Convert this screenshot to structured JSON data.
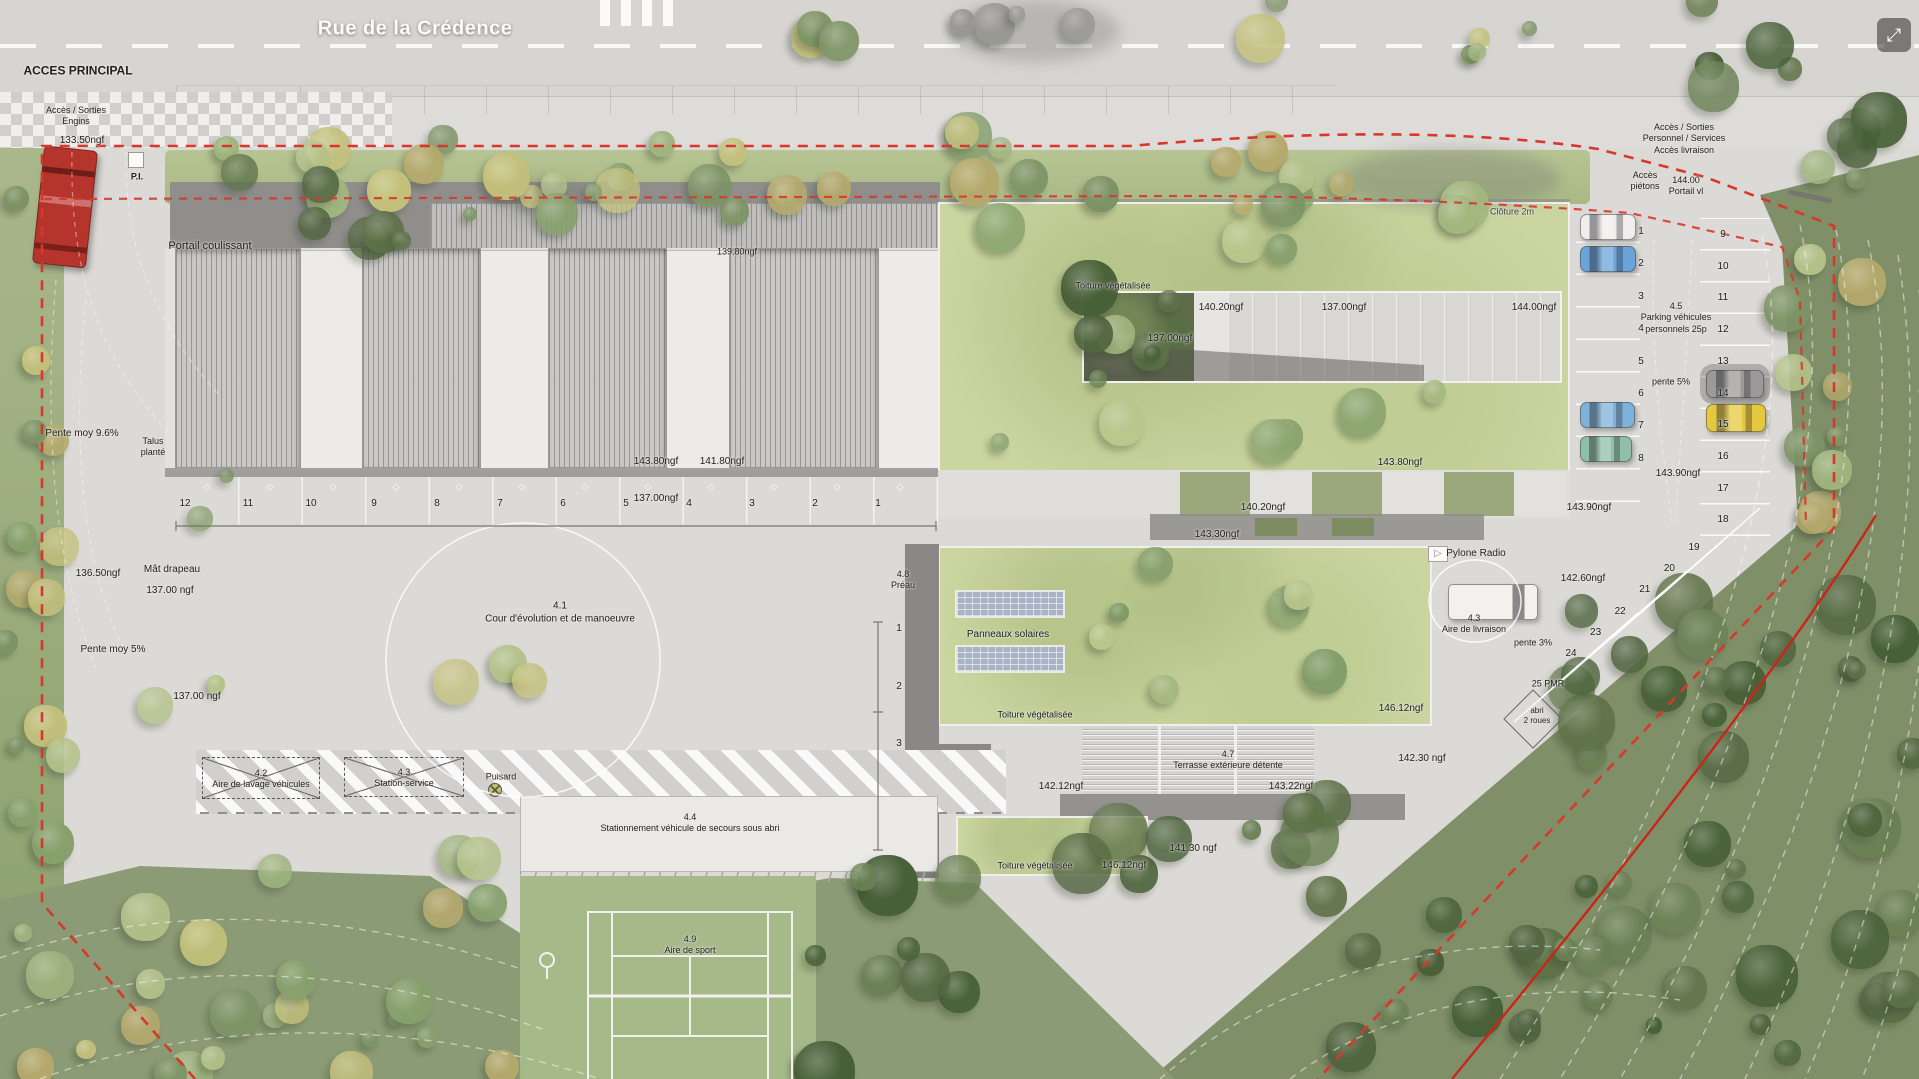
{
  "viewer": {
    "fullscreen_icon": "⤢"
  },
  "colors": {
    "boundary_red": "#d8372b",
    "solid_red": "#cc2418",
    "roof_green": "#cbd5a0",
    "forest_green": "#7f9068",
    "road_gray": "#d7d5d2",
    "truck_red": "#b5352c",
    "car_yellow": "#e6c83e",
    "car_blue": "#6aa4d8"
  },
  "annotations": [
    {
      "text": "Rue de la Crédence",
      "x": 415,
      "y": 29,
      "size": 20,
      "cls": "street"
    },
    {
      "text": "ACCES PRINCIPAL",
      "x": 78,
      "y": 71,
      "size": 12,
      "weight": "600"
    },
    {
      "text": "Accès / Sorties\nEngins",
      "x": 76,
      "y": 116,
      "size": 9
    },
    {
      "text": "133.50ngf",
      "x": 82,
      "y": 141,
      "size": 10
    },
    {
      "text": "P.I.",
      "x": 137,
      "y": 177,
      "size": 9,
      "weight": "600"
    },
    {
      "text": "Portail coulissant",
      "x": 210,
      "y": 247,
      "size": 11
    },
    {
      "text": "Pente moy 9.6%",
      "x": 82,
      "y": 434,
      "size": 10
    },
    {
      "text": "Talus\nplanté",
      "x": 153,
      "y": 447,
      "size": 9
    },
    {
      "text": "136.50ngf",
      "x": 98,
      "y": 574,
      "size": 10
    },
    {
      "text": "Mât drapeau",
      "x": 172,
      "y": 570,
      "size": 10
    },
    {
      "text": "137.00 ngf",
      "x": 170,
      "y": 591,
      "size": 10
    },
    {
      "text": "Pente moy 5%",
      "x": 113,
      "y": 650,
      "size": 10
    },
    {
      "text": "137.00 ngf",
      "x": 197,
      "y": 697,
      "size": 10
    },
    {
      "text": "4.1\nCour d'évolution et de manoeuvre",
      "x": 560,
      "y": 613,
      "size": 10
    },
    {
      "text": "139.80ngf",
      "x": 737,
      "y": 252,
      "size": 9
    },
    {
      "text": "143.80ngf",
      "x": 656,
      "y": 462,
      "size": 10
    },
    {
      "text": "141.80ngf",
      "x": 722,
      "y": 462,
      "size": 10
    },
    {
      "text": "137.00ngf",
      "x": 656,
      "y": 499,
      "size": 10
    },
    {
      "text": "Toiture végétalisée",
      "x": 1113,
      "y": 286,
      "size": 9
    },
    {
      "text": "140.20ngf",
      "x": 1221,
      "y": 308,
      "size": 10
    },
    {
      "text": "137.00ngf",
      "x": 1344,
      "y": 308,
      "size": 10
    },
    {
      "text": "144.00ngf",
      "x": 1534,
      "y": 308,
      "size": 10
    },
    {
      "text": "137.00ngf",
      "x": 1170,
      "y": 339,
      "size": 10
    },
    {
      "text": "143.80ngf",
      "x": 1400,
      "y": 463,
      "size": 10
    },
    {
      "text": "140.20ngf",
      "x": 1263,
      "y": 508,
      "size": 10
    },
    {
      "text": "143.30ngf",
      "x": 1217,
      "y": 535,
      "size": 10
    },
    {
      "text": "143.90ngf",
      "x": 1589,
      "y": 508,
      "size": 10
    },
    {
      "text": "4.8\nPréau",
      "x": 903,
      "y": 580,
      "size": 9
    },
    {
      "text": "Panneaux solaires",
      "x": 1008,
      "y": 635,
      "size": 10
    },
    {
      "text": "Toiture végétalisée",
      "x": 1035,
      "y": 715,
      "size": 9
    },
    {
      "text": "146.12ngf",
      "x": 1401,
      "y": 709,
      "size": 10
    },
    {
      "text": "4.7\nTerrasse extérieure détente",
      "x": 1228,
      "y": 760,
      "size": 9
    },
    {
      "text": "142.12ngf",
      "x": 1061,
      "y": 787,
      "size": 10
    },
    {
      "text": "143.22ngf",
      "x": 1291,
      "y": 787,
      "size": 10
    },
    {
      "text": "142.30 ngf",
      "x": 1422,
      "y": 759,
      "size": 10
    },
    {
      "text": "Toiture végétalisée",
      "x": 1035,
      "y": 866,
      "size": 9
    },
    {
      "text": "146.12ngf",
      "x": 1124,
      "y": 866,
      "size": 10
    },
    {
      "text": "141.30 ngf",
      "x": 1193,
      "y": 849,
      "size": 10
    },
    {
      "text": "4.2\nAire de lavage véhicules",
      "x": 261,
      "y": 779,
      "size": 9
    },
    {
      "text": "4.3\nStation-service",
      "x": 404,
      "y": 778,
      "size": 9
    },
    {
      "text": "Puisard",
      "x": 501,
      "y": 777,
      "size": 9
    },
    {
      "text": "4.4\nStationnement véhicule de secours sous abri",
      "x": 690,
      "y": 823,
      "size": 9
    },
    {
      "text": "4.9\nAire de sport",
      "x": 690,
      "y": 945,
      "size": 9
    },
    {
      "text": "Accès / Sorties\nPersonnel / Services\nAccès livraison",
      "x": 1684,
      "y": 139,
      "size": 9
    },
    {
      "text": "Accès\npiétons",
      "x": 1645,
      "y": 181,
      "size": 9
    },
    {
      "text": "144.00\nPortail vl",
      "x": 1686,
      "y": 186,
      "size": 9
    },
    {
      "text": "Clôture 2m",
      "x": 1512,
      "y": 212,
      "size": 9,
      "color": "#45453e"
    },
    {
      "text": "4.5\nParking véhicules\npersonnels 25p",
      "x": 1676,
      "y": 318,
      "size": 9
    },
    {
      "text": "pente 5%",
      "x": 1671,
      "y": 382,
      "size": 9
    },
    {
      "text": "143.90ngf",
      "x": 1678,
      "y": 474,
      "size": 10
    },
    {
      "text": "Pylone Radio",
      "x": 1476,
      "y": 554,
      "size": 10
    },
    {
      "text": "142.60ngf",
      "x": 1583,
      "y": 579,
      "size": 10
    },
    {
      "text": "4.3\nAire de livraison",
      "x": 1474,
      "y": 624,
      "size": 9
    },
    {
      "text": "pente 3%",
      "x": 1533,
      "y": 643,
      "size": 9
    },
    {
      "text": "25 PMR",
      "x": 1548,
      "y": 684,
      "size": 9
    },
    {
      "text": "abri\n2 roues",
      "x": 1537,
      "y": 716,
      "size": 8
    }
  ],
  "parking": {
    "bays_left_to_right": [
      "12",
      "11",
      "10",
      "9",
      "8",
      "7",
      "6",
      "5",
      "4",
      "3",
      "2",
      "1"
    ],
    "column_a": [
      "1",
      "2",
      "3",
      "4",
      "5",
      "6",
      "7",
      "8"
    ],
    "column_b": [
      "9",
      "10",
      "11",
      "12",
      "13",
      "14",
      "15",
      "16",
      "17",
      "18"
    ],
    "diagonal": [
      "19",
      "20",
      "21",
      "22",
      "23",
      "24"
    ],
    "preau_marks": [
      "1",
      "2",
      "3"
    ]
  }
}
